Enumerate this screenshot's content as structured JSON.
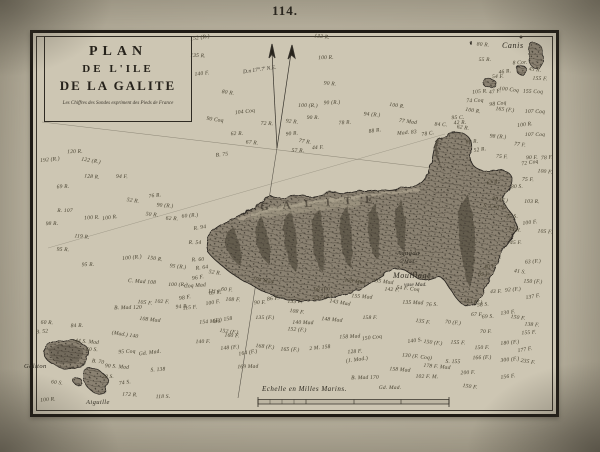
{
  "page": {
    "number": "114."
  },
  "title_block": {
    "line1": "PLAN",
    "line2": "DE L'ILE",
    "line3": "DE LA GALITE",
    "note": "Les Chiffres des Sondes expriment des Pieds de France"
  },
  "compass": {
    "declination_label": "D.n 17°.7' N.E."
  },
  "scale": {
    "label": "Echelle en Milles Marins."
  },
  "island": {
    "name_letters": "GALITE"
  },
  "colors": {
    "paper_margin": "#b7b09d",
    "chart_paper": "#cdc6b3",
    "ink": "#2e2a22",
    "island_base": "#8a8171",
    "island_shadow": "#453f33",
    "frame": "#1f1b15"
  },
  "map_labels": [
    {
      "name": "label-canis",
      "x": 502,
      "y": 41,
      "text": "Canis",
      "cls": "lbl-md"
    },
    {
      "name": "label-galiton",
      "x": 24,
      "y": 363,
      "text": "Galiton",
      "cls": "lbl-sm"
    },
    {
      "name": "label-aiguille",
      "x": 86,
      "y": 399,
      "text": "Aiguille",
      "cls": "lbl-sm"
    },
    {
      "name": "label-aguada",
      "x": 397,
      "y": 250,
      "text": "Aguada",
      "cls": "lbl-sm"
    },
    {
      "name": "label-5-mad",
      "x": 400,
      "y": 259,
      "text": "5 Mad.",
      "cls": "lbl-xs"
    },
    {
      "name": "label-mouillage",
      "x": 393,
      "y": 271,
      "text": "Mouillage",
      "cls": "lbl-md"
    },
    {
      "name": "label-vase-mad",
      "x": 404,
      "y": 282,
      "text": "vase Mad.",
      "cls": "lbl-xs"
    }
  ],
  "soundings": [
    {
      "x": 200,
      "y": 38,
      "t": "152 (R.)"
    },
    {
      "x": 322,
      "y": 37,
      "t": "133 R."
    },
    {
      "x": 198,
      "y": 56,
      "t": "135 R."
    },
    {
      "x": 326,
      "y": 58,
      "t": "100 R."
    },
    {
      "x": 202,
      "y": 74,
      "t": "140 F."
    },
    {
      "x": 228,
      "y": 93,
      "t": "80 R."
    },
    {
      "x": 330,
      "y": 84,
      "t": "90 R."
    },
    {
      "x": 308,
      "y": 106,
      "t": "100 (R.)"
    },
    {
      "x": 332,
      "y": 103,
      "t": "90 (R.)"
    },
    {
      "x": 245,
      "y": 112,
      "t": "104 Coq"
    },
    {
      "x": 397,
      "y": 106,
      "t": "100 R."
    },
    {
      "x": 372,
      "y": 115,
      "t": "94 (R.)"
    },
    {
      "x": 313,
      "y": 118,
      "t": "90 R."
    },
    {
      "x": 345,
      "y": 123,
      "t": "78 R."
    },
    {
      "x": 375,
      "y": 131,
      "t": "88 R."
    },
    {
      "x": 408,
      "y": 122,
      "t": "77 Mad"
    },
    {
      "x": 441,
      "y": 125,
      "t": "84 C."
    },
    {
      "x": 458,
      "y": 118,
      "t": "95 C."
    },
    {
      "x": 407,
      "y": 133,
      "t": "Mad. 83"
    },
    {
      "x": 428,
      "y": 134,
      "t": "78 C."
    },
    {
      "x": 292,
      "y": 122,
      "t": "92 R."
    },
    {
      "x": 267,
      "y": 124,
      "t": "72 R."
    },
    {
      "x": 237,
      "y": 134,
      "t": "62 R."
    },
    {
      "x": 292,
      "y": 134,
      "t": "90 R."
    },
    {
      "x": 305,
      "y": 142,
      "t": "77 R."
    },
    {
      "x": 252,
      "y": 143,
      "t": "67 R."
    },
    {
      "x": 298,
      "y": 151,
      "t": "57 R."
    },
    {
      "x": 318,
      "y": 148,
      "t": "44 F."
    },
    {
      "x": 222,
      "y": 155,
      "t": "B. 75"
    },
    {
      "x": 215,
      "y": 120,
      "t": "90 Coq"
    },
    {
      "x": 483,
      "y": 45,
      "t": "80 R."
    },
    {
      "x": 485,
      "y": 60,
      "t": "55 R."
    },
    {
      "x": 520,
      "y": 63,
      "t": "8 Cor."
    },
    {
      "x": 505,
      "y": 72,
      "t": "46 R."
    },
    {
      "x": 535,
      "y": 70,
      "t": "45 R."
    },
    {
      "x": 540,
      "y": 79,
      "t": "155 F."
    },
    {
      "x": 498,
      "y": 77,
      "t": "54 F."
    },
    {
      "x": 480,
      "y": 92,
      "t": "105 R."
    },
    {
      "x": 495,
      "y": 92,
      "t": "47 F."
    },
    {
      "x": 509,
      "y": 90,
      "t": "100 Coq"
    },
    {
      "x": 533,
      "y": 92,
      "t": "155 Coq"
    },
    {
      "x": 475,
      "y": 101,
      "t": "74 Coq"
    },
    {
      "x": 498,
      "y": 104,
      "t": "98 Coq"
    },
    {
      "x": 473,
      "y": 111,
      "t": "100 R."
    },
    {
      "x": 505,
      "y": 110,
      "t": "165 (F.)"
    },
    {
      "x": 535,
      "y": 112,
      "t": "107 Coq"
    },
    {
      "x": 460,
      "y": 123,
      "t": "42 R."
    },
    {
      "x": 525,
      "y": 125,
      "t": "100 R."
    },
    {
      "x": 463,
      "y": 128,
      "t": "62 R."
    },
    {
      "x": 498,
      "y": 137,
      "t": "98 (R.)"
    },
    {
      "x": 535,
      "y": 135,
      "t": "107 Coq"
    },
    {
      "x": 472,
      "y": 142,
      "t": "60 R."
    },
    {
      "x": 480,
      "y": 150,
      "t": "52 R."
    },
    {
      "x": 520,
      "y": 145,
      "t": "77 F."
    },
    {
      "x": 502,
      "y": 157,
      "t": "75 F."
    },
    {
      "x": 532,
      "y": 158,
      "t": "90 F."
    },
    {
      "x": 547,
      "y": 158,
      "t": "78 F."
    },
    {
      "x": 530,
      "y": 163,
      "t": "72 Coq"
    },
    {
      "x": 545,
      "y": 172,
      "t": "100 F."
    },
    {
      "x": 528,
      "y": 180,
      "t": "75 F."
    },
    {
      "x": 517,
      "y": 187,
      "t": "80 S."
    },
    {
      "x": 493,
      "y": 183,
      "t": "67 R."
    },
    {
      "x": 500,
      "y": 200,
      "t": "90 (F.)"
    },
    {
      "x": 495,
      "y": 207,
      "t": "S. Coq 92"
    },
    {
      "x": 532,
      "y": 202,
      "t": "103 R."
    },
    {
      "x": 512,
      "y": 217,
      "t": "75 S."
    },
    {
      "x": 530,
      "y": 223,
      "t": "100 F."
    },
    {
      "x": 515,
      "y": 230,
      "t": "45 R."
    },
    {
      "x": 545,
      "y": 232,
      "t": "105 F."
    },
    {
      "x": 516,
      "y": 243,
      "t": "45 F."
    },
    {
      "x": 533,
      "y": 262,
      "t": "63 (F.)"
    },
    {
      "x": 490,
      "y": 267,
      "t": "40 F."
    },
    {
      "x": 520,
      "y": 272,
      "t": "41 S."
    },
    {
      "x": 484,
      "y": 275,
      "t": "65 F."
    },
    {
      "x": 496,
      "y": 292,
      "t": "43 F."
    },
    {
      "x": 513,
      "y": 290,
      "t": "92 (F.)"
    },
    {
      "x": 533,
      "y": 297,
      "t": "137 F."
    },
    {
      "x": 473,
      "y": 302,
      "t": "103 (F.)"
    },
    {
      "x": 533,
      "y": 282,
      "t": "150 (F.)"
    },
    {
      "x": 75,
      "y": 152,
      "t": "120 R."
    },
    {
      "x": 50,
      "y": 160,
      "t": "192 (R.)"
    },
    {
      "x": 91,
      "y": 161,
      "t": "122 (R.)"
    },
    {
      "x": 92,
      "y": 177,
      "t": "128 R."
    },
    {
      "x": 122,
      "y": 177,
      "t": "94 F."
    },
    {
      "x": 63,
      "y": 187,
      "t": "69 R."
    },
    {
      "x": 155,
      "y": 196,
      "t": "76 R."
    },
    {
      "x": 133,
      "y": 201,
      "t": "52 R."
    },
    {
      "x": 165,
      "y": 206,
      "t": "90 (R.)"
    },
    {
      "x": 65,
      "y": 211,
      "t": "R. 107"
    },
    {
      "x": 92,
      "y": 218,
      "t": "100 R."
    },
    {
      "x": 110,
      "y": 218,
      "t": "100 R."
    },
    {
      "x": 152,
      "y": 215,
      "t": "50 R."
    },
    {
      "x": 172,
      "y": 219,
      "t": "62 R."
    },
    {
      "x": 52,
      "y": 224,
      "t": "98 R."
    },
    {
      "x": 190,
      "y": 216,
      "t": "60 (R.)"
    },
    {
      "x": 200,
      "y": 228,
      "t": "R. 94"
    },
    {
      "x": 82,
      "y": 237,
      "t": "119 R."
    },
    {
      "x": 63,
      "y": 250,
      "t": "95 R."
    },
    {
      "x": 88,
      "y": 265,
      "t": "95 R."
    },
    {
      "x": 132,
      "y": 258,
      "t": "100 (R.)"
    },
    {
      "x": 155,
      "y": 259,
      "t": "150 R."
    },
    {
      "x": 178,
      "y": 267,
      "t": "95 (R.)"
    },
    {
      "x": 195,
      "y": 243,
      "t": "R. 54"
    },
    {
      "x": 198,
      "y": 260,
      "t": "R. 60"
    },
    {
      "x": 202,
      "y": 268,
      "t": "R. 64"
    },
    {
      "x": 215,
      "y": 273,
      "t": "52 R."
    },
    {
      "x": 142,
      "y": 282,
      "t": "C. Mad 108"
    },
    {
      "x": 178,
      "y": 285,
      "t": "100 (R.)"
    },
    {
      "x": 195,
      "y": 286,
      "t": "Coq Mad"
    },
    {
      "x": 215,
      "y": 293,
      "t": "65 F."
    },
    {
      "x": 145,
      "y": 303,
      "t": "105 F."
    },
    {
      "x": 162,
      "y": 302,
      "t": "102 F."
    },
    {
      "x": 128,
      "y": 308,
      "t": "B. Mad 120"
    },
    {
      "x": 182,
      "y": 307,
      "t": "94 R."
    },
    {
      "x": 213,
      "y": 303,
      "t": "100 F."
    },
    {
      "x": 150,
      "y": 320,
      "t": "108 Mad"
    },
    {
      "x": 47,
      "y": 323,
      "t": "60 R."
    },
    {
      "x": 77,
      "y": 326,
      "t": "84 R."
    },
    {
      "x": 42,
      "y": 332,
      "t": "B. 52"
    },
    {
      "x": 125,
      "y": 335,
      "t": "(Mad.) 140"
    },
    {
      "x": 87,
      "y": 342,
      "t": "44 S. Mad"
    },
    {
      "x": 92,
      "y": 350,
      "t": "60 S."
    },
    {
      "x": 127,
      "y": 352,
      "t": "95 Coq"
    },
    {
      "x": 150,
      "y": 353,
      "t": "Gd. Mad."
    },
    {
      "x": 98,
      "y": 362,
      "t": "B. 70"
    },
    {
      "x": 117,
      "y": 367,
      "t": "90 S. Mad"
    },
    {
      "x": 108,
      "y": 377,
      "t": "28 S."
    },
    {
      "x": 158,
      "y": 370,
      "t": "S. 138"
    },
    {
      "x": 125,
      "y": 383,
      "t": "74 S."
    },
    {
      "x": 57,
      "y": 383,
      "t": "60 S."
    },
    {
      "x": 130,
      "y": 395,
      "t": "172 R."
    },
    {
      "x": 163,
      "y": 397,
      "t": "118 S."
    },
    {
      "x": 48,
      "y": 400,
      "t": "100 R."
    },
    {
      "x": 198,
      "y": 278,
      "t": "96 F."
    },
    {
      "x": 215,
      "y": 292,
      "t": "111 F."
    },
    {
      "x": 233,
      "y": 300,
      "t": "108 F."
    },
    {
      "x": 260,
      "y": 303,
      "t": "90 F."
    },
    {
      "x": 273,
      "y": 299,
      "t": "86 F."
    },
    {
      "x": 263,
      "y": 281,
      "t": "104 Mad"
    },
    {
      "x": 227,
      "y": 290,
      "t": "60 F."
    },
    {
      "x": 295,
      "y": 302,
      "t": "135 F."
    },
    {
      "x": 322,
      "y": 290,
      "t": "98 (F.)"
    },
    {
      "x": 323,
      "y": 298,
      "t": "137 (F.)"
    },
    {
      "x": 297,
      "y": 312,
      "t": "108 F."
    },
    {
      "x": 297,
      "y": 330,
      "t": "152 (F.)"
    },
    {
      "x": 265,
      "y": 318,
      "t": "135 (F.)"
    },
    {
      "x": 210,
      "y": 322,
      "t": "154 Mad"
    },
    {
      "x": 223,
      "y": 320,
      "t": "(F.) 158"
    },
    {
      "x": 229,
      "y": 332,
      "t": "152 (F.)"
    },
    {
      "x": 232,
      "y": 336,
      "t": "160 F."
    },
    {
      "x": 203,
      "y": 342,
      "t": "140 F."
    },
    {
      "x": 230,
      "y": 348,
      "t": "148 (F.)"
    },
    {
      "x": 248,
      "y": 353,
      "t": "164 (F.)"
    },
    {
      "x": 265,
      "y": 347,
      "t": "168 (F.)"
    },
    {
      "x": 290,
      "y": 350,
      "t": "165 (F.)"
    },
    {
      "x": 248,
      "y": 367,
      "t": "169 Mad"
    },
    {
      "x": 320,
      "y": 348,
      "t": "2 M. 158"
    },
    {
      "x": 340,
      "y": 303,
      "t": "143 Mad"
    },
    {
      "x": 332,
      "y": 320,
      "t": "148 Mad"
    },
    {
      "x": 303,
      "y": 323,
      "t": "140 Mad"
    },
    {
      "x": 350,
      "y": 337,
      "t": "158 Mad"
    },
    {
      "x": 372,
      "y": 338,
      "t": "150 Coq"
    },
    {
      "x": 355,
      "y": 282,
      "t": "123 Mad"
    },
    {
      "x": 362,
      "y": 297,
      "t": "155 Mad"
    },
    {
      "x": 370,
      "y": 318,
      "t": "158 F."
    },
    {
      "x": 355,
      "y": 352,
      "t": "128 F."
    },
    {
      "x": 357,
      "y": 360,
      "t": "(J. Mad.)"
    },
    {
      "x": 383,
      "y": 282,
      "t": "135 Mad"
    },
    {
      "x": 392,
      "y": 290,
      "t": "142 F."
    },
    {
      "x": 365,
      "y": 378,
      "t": "B. Mad 170"
    },
    {
      "x": 190,
      "y": 308,
      "t": "115 F."
    },
    {
      "x": 185,
      "y": 298,
      "t": "98 F."
    },
    {
      "x": 408,
      "y": 289,
      "t": "54 F. Coq"
    },
    {
      "x": 413,
      "y": 303,
      "t": "135 Mad"
    },
    {
      "x": 432,
      "y": 305,
      "t": "76 S."
    },
    {
      "x": 483,
      "y": 305,
      "t": "58 S."
    },
    {
      "x": 423,
      "y": 322,
      "t": "135 F."
    },
    {
      "x": 453,
      "y": 323,
      "t": "70 (F.)"
    },
    {
      "x": 477,
      "y": 315,
      "t": "67 F."
    },
    {
      "x": 488,
      "y": 317,
      "t": "69 S."
    },
    {
      "x": 508,
      "y": 313,
      "t": "130 F."
    },
    {
      "x": 518,
      "y": 318,
      "t": "150 F."
    },
    {
      "x": 532,
      "y": 325,
      "t": "138 F."
    },
    {
      "x": 486,
      "y": 332,
      "t": "70 F."
    },
    {
      "x": 529,
      "y": 333,
      "t": "155 F."
    },
    {
      "x": 415,
      "y": 341,
      "t": "140 S."
    },
    {
      "x": 433,
      "y": 343,
      "t": "150 (F.)"
    },
    {
      "x": 458,
      "y": 343,
      "t": "155 F."
    },
    {
      "x": 482,
      "y": 348,
      "t": "150 F."
    },
    {
      "x": 510,
      "y": 343,
      "t": "180 (F.)"
    },
    {
      "x": 525,
      "y": 350,
      "t": "177 F."
    },
    {
      "x": 417,
      "y": 357,
      "t": "130 (F. Coq)"
    },
    {
      "x": 453,
      "y": 362,
      "t": "S. 155"
    },
    {
      "x": 482,
      "y": 358,
      "t": "166 (F.)"
    },
    {
      "x": 510,
      "y": 360,
      "t": "300 (F.)"
    },
    {
      "x": 528,
      "y": 362,
      "t": "235 F."
    },
    {
      "x": 437,
      "y": 367,
      "t": "178 F. Mad"
    },
    {
      "x": 427,
      "y": 377,
      "t": "102 F. M."
    },
    {
      "x": 468,
      "y": 373,
      "t": "200 F."
    },
    {
      "x": 508,
      "y": 377,
      "t": "156 F."
    },
    {
      "x": 470,
      "y": 387,
      "t": "150 F."
    },
    {
      "x": 400,
      "y": 370,
      "t": "158 Mad"
    },
    {
      "x": 390,
      "y": 388,
      "t": "Gd. Mad."
    }
  ]
}
